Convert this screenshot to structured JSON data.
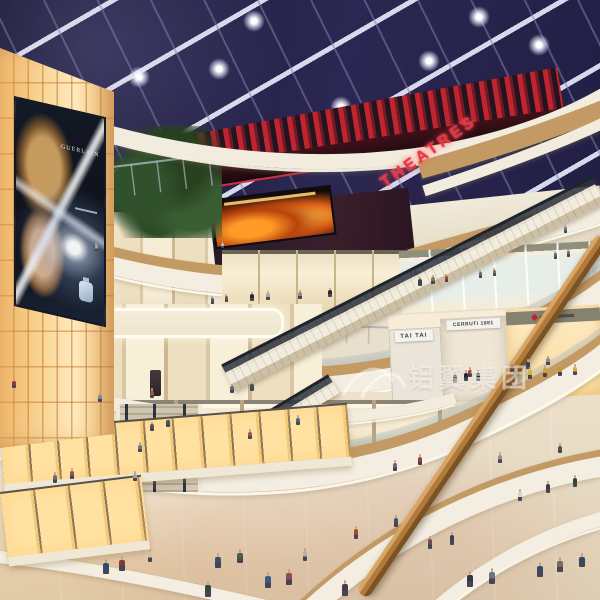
{
  "scene": {
    "description": "Architectural rendering of a multi-level shopping mall atrium with curved balconies, escalators, glowing amber feature wall and skylight ceiling"
  },
  "signs": {
    "theatre": "THEATRES",
    "billboard_brand": "GUERLAIN",
    "shop_a": "TAI TAI",
    "shop_b": "CERRUTI 1881"
  },
  "watermark": {
    "text": "铝翼集团"
  },
  "colors": {
    "theatre_red": "#c8232f",
    "amber_wall": "#f6c87e",
    "ceiling_navy": "#262243",
    "wood_fascia": "#c39a63",
    "cream_fascia": "#f3eee1",
    "floor_beige": "#e8dfcc",
    "handrail_wood": "#b07a3c"
  },
  "figures": [
    [
      106,
      574,
      15,
      "#2a4f7a"
    ],
    [
      122,
      571,
      15,
      "#7a3b3b"
    ],
    [
      150,
      562,
      13,
      "#c8c2b4"
    ],
    [
      218,
      568,
      15,
      "#38506e"
    ],
    [
      240,
      563,
      14,
      "#515e43"
    ],
    [
      268,
      588,
      16,
      "#3b5a8c"
    ],
    [
      289,
      585,
      16,
      "#8c4a5a"
    ],
    [
      305,
      561,
      13,
      "#b5b0a5"
    ],
    [
      356,
      539,
      13,
      "#b0452f"
    ],
    [
      396,
      527,
      12,
      "#44506a"
    ],
    [
      430,
      549,
      13,
      "#6e4a58"
    ],
    [
      452,
      545,
      13,
      "#32435c"
    ],
    [
      470,
      587,
      16,
      "#2f3b49"
    ],
    [
      492,
      584,
      16,
      "#6b7487"
    ],
    [
      540,
      577,
      15,
      "#3a4a62"
    ],
    [
      560,
      572,
      15,
      "#7d6a55"
    ],
    [
      582,
      567,
      14,
      "#2c4a68"
    ],
    [
      345,
      596,
      16,
      "#4a3a52"
    ],
    [
      208,
      597,
      16,
      "#2f4a40"
    ],
    [
      55,
      483,
      11,
      "#5a6f8f"
    ],
    [
      72,
      479,
      11,
      "#8a5f3f"
    ],
    [
      135,
      481,
      10,
      "#9aa4b0"
    ],
    [
      395,
      471,
      11,
      "#70657a"
    ],
    [
      420,
      465,
      11,
      "#a04032"
    ],
    [
      520,
      501,
      12,
      "#d8d4c8"
    ],
    [
      548,
      493,
      12,
      "#433a44"
    ],
    [
      575,
      487,
      12,
      "#2a4a33"
    ],
    [
      500,
      463,
      11,
      "#8a94a0"
    ],
    [
      560,
      453,
      10,
      "#64503c"
    ],
    [
      100,
      402,
      10,
      "#7a86a0"
    ],
    [
      152,
      398,
      10,
      "#97564a"
    ],
    [
      232,
      393,
      9,
      "#5a6a7c"
    ],
    [
      252,
      391,
      9,
      "#46505e"
    ],
    [
      14,
      388,
      10,
      "#a03040"
    ],
    [
      512,
      372,
      10,
      "#6a3a2a"
    ],
    [
      528,
      369,
      10,
      "#24466a"
    ],
    [
      548,
      365,
      9,
      "#8a8a92"
    ],
    [
      470,
      377,
      10,
      "#a03a3a"
    ],
    [
      212,
      304,
      8,
      "#4a5a6c"
    ],
    [
      226,
      302,
      8,
      "#6c5a4a"
    ],
    [
      420,
      286,
      9,
      "#34465a"
    ],
    [
      433,
      284,
      9,
      "#86766a"
    ],
    [
      446,
      282,
      8,
      "#a04444"
    ],
    [
      555,
      259,
      8,
      "#5a6a80"
    ],
    [
      568,
      257,
      8,
      "#7a6a5a"
    ],
    [
      96,
      251,
      8,
      "#9aa6b2"
    ],
    [
      222,
      248,
      7,
      "#b0bac4"
    ],
    [
      480,
      278,
      8,
      "#5c6c7e"
    ],
    [
      494,
      276,
      8,
      "#7e6c5c"
    ],
    [
      565,
      233,
      8,
      "#68788c"
    ],
    [
      250,
      439,
      10,
      "#a05548"
    ],
    [
      298,
      425,
      10,
      "#46688c"
    ],
    [
      152,
      431,
      9,
      "#5c4a6a"
    ],
    [
      168,
      427,
      9,
      "#3a566a"
    ],
    [
      140,
      452,
      10,
      "#6a7a8c"
    ],
    [
      455,
      383,
      11,
      "#1c1c22"
    ],
    [
      466,
      381,
      11,
      "#23232b"
    ],
    [
      478,
      381,
      11,
      "#1c1c22"
    ],
    [
      530,
      379,
      12,
      "#d8b040"
    ],
    [
      545,
      377,
      12,
      "#caa034"
    ],
    [
      560,
      376,
      12,
      "#c09a30"
    ],
    [
      575,
      375,
      11,
      "#d4ae3e"
    ],
    [
      252,
      301,
      9,
      "#2a2a32"
    ],
    [
      268,
      300,
      9,
      "#b0a8a0"
    ],
    [
      300,
      299,
      9,
      "#8a8a92"
    ],
    [
      330,
      297,
      9,
      "#2a2a32"
    ]
  ]
}
